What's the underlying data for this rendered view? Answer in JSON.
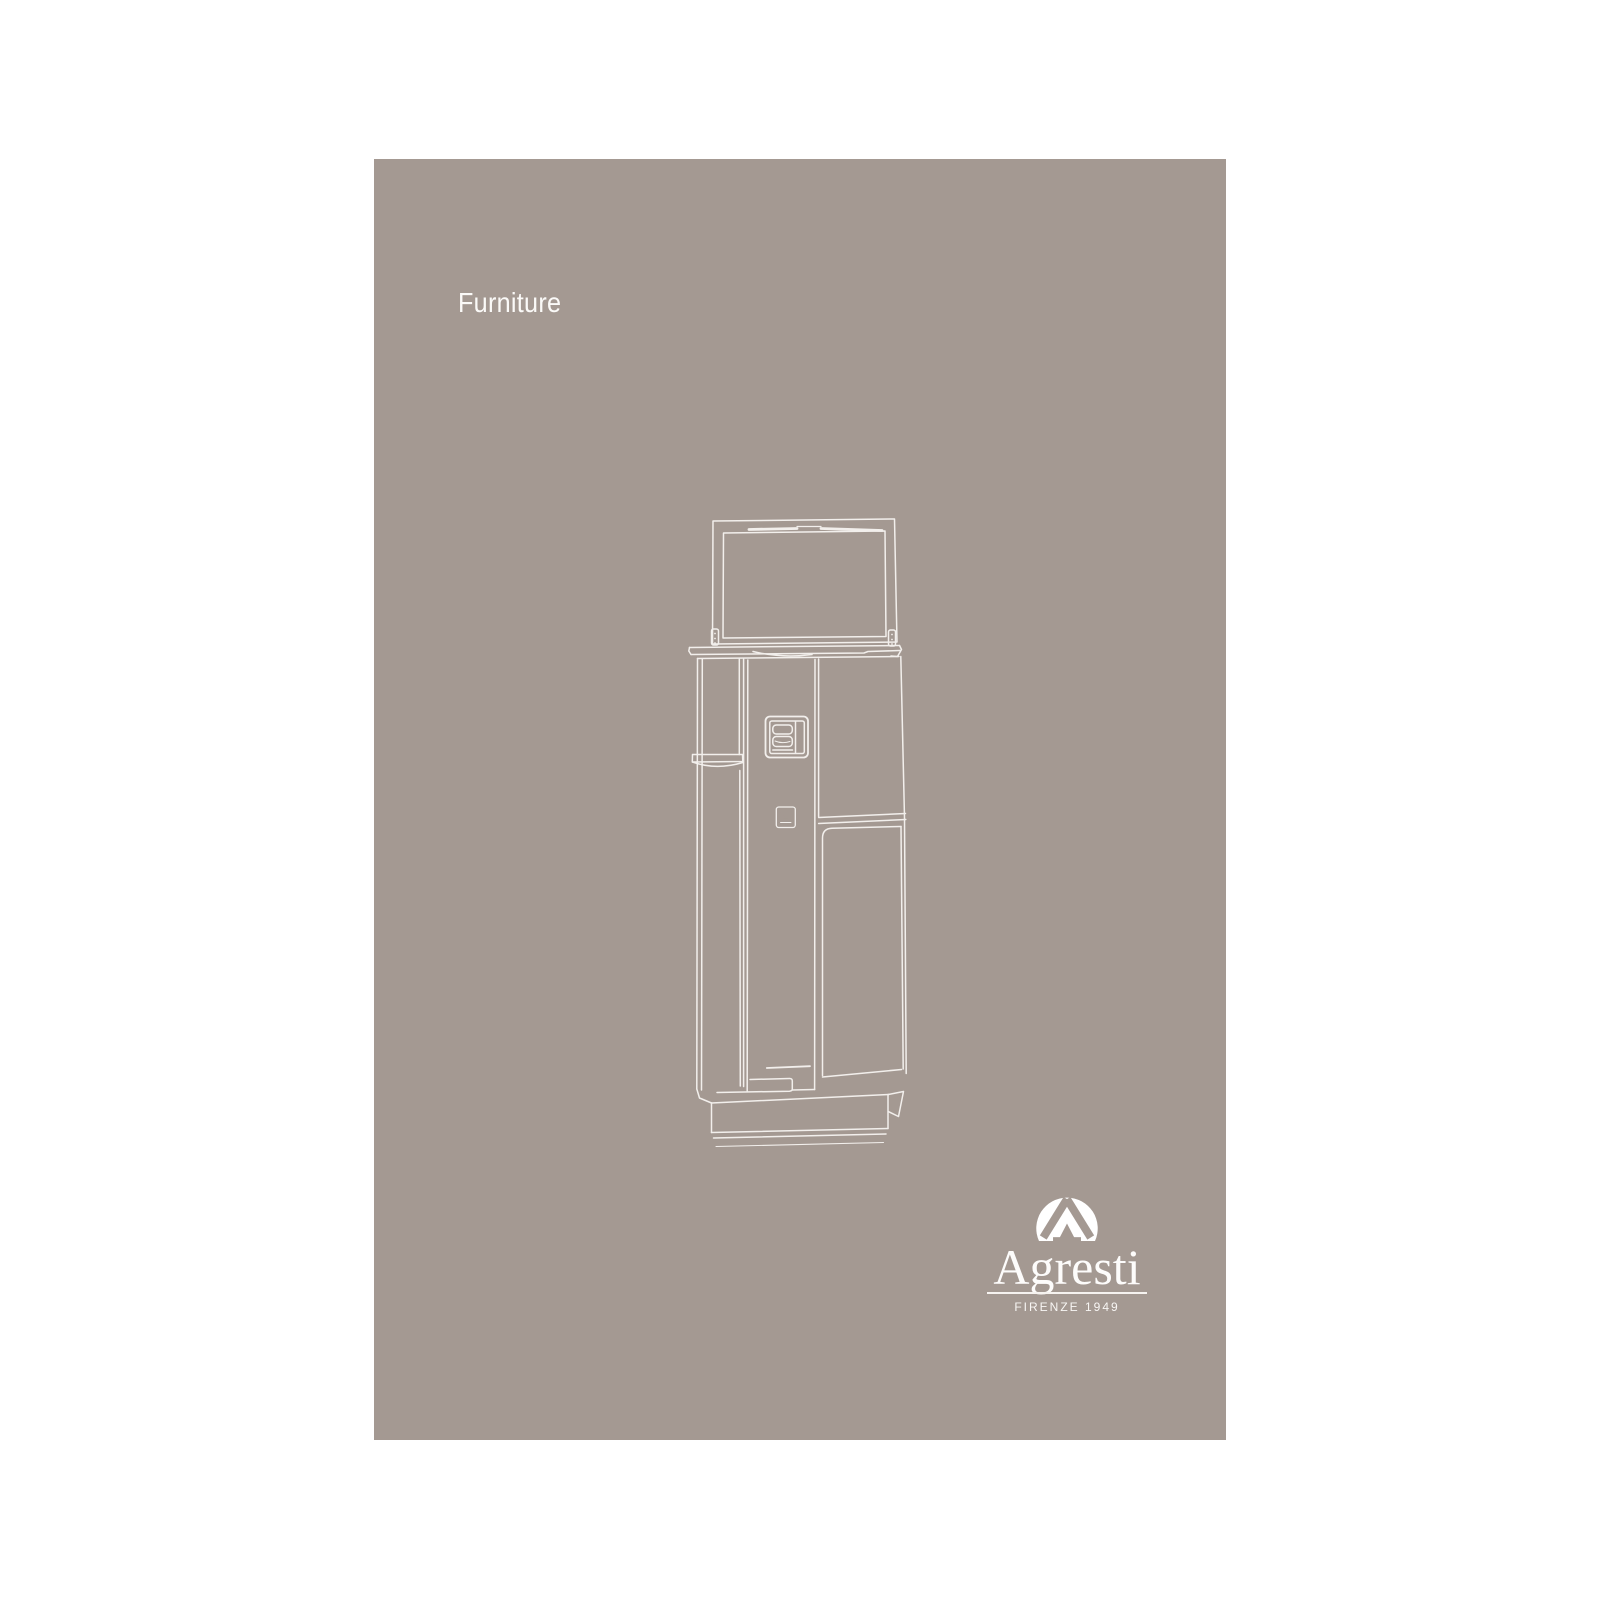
{
  "cover": {
    "category_label": "Furniture",
    "brand": {
      "name": "Agresti",
      "tagline": "FIRENZE 1949",
      "mark_icon": "agresti-a-circle-monogram"
    },
    "illustration": "armored-safe-open-lid-line-drawing",
    "colors": {
      "canvas_background": "#ffffff",
      "page_background": "#a49992",
      "artwork_line": "#f7f4f1",
      "text": "#fbfaf8"
    }
  }
}
